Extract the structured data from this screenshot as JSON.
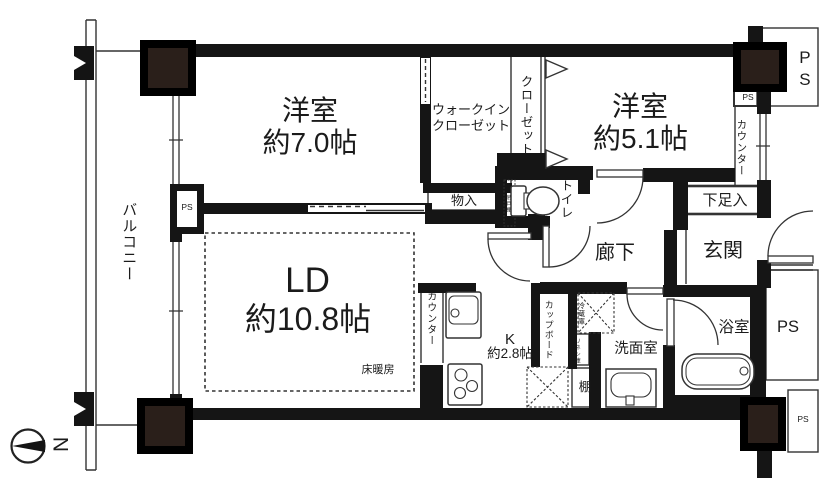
{
  "colors": {
    "wall": "#151515",
    "pillar": "#2a1f1a",
    "line": "#333333",
    "bg": "#ffffff"
  },
  "rooms": {
    "western7": {
      "name": "洋室",
      "size": "約7.0帖"
    },
    "western51": {
      "name": "洋室",
      "size": "約5.1帖"
    },
    "living_dining": {
      "name": "LD",
      "size": "約10.8帖",
      "note": "床暖房"
    },
    "kitchen": {
      "name": "K",
      "size": "約2.8帖"
    },
    "walk_in_closet": {
      "line1": "ウォークイン",
      "line2": "クローゼット"
    },
    "closet": "クローゼット",
    "balcony": "バルコニー",
    "hallway": "廊下",
    "entrance": "玄関",
    "bathroom": "浴室",
    "washroom": "洗面室",
    "toilet": "トイレ"
  },
  "storage": {
    "monoire": "物入",
    "getabako": "下足入",
    "cupboard": "カップボード",
    "refrigerator": "冷蔵庫",
    "linen": "リネン庫",
    "shelf": "棚",
    "hanging_cabinet": "吊戸棚",
    "counter_entrance": "カウンター",
    "counter_kitchen": "カウンター"
  },
  "pipe_spaces": {
    "ps_top_large": "PS",
    "ps_top_small": "PS",
    "ps_balcony": "PS",
    "ps_bath": "PS",
    "ps_bottom_small": "PS"
  },
  "compass": {
    "north": "N"
  }
}
